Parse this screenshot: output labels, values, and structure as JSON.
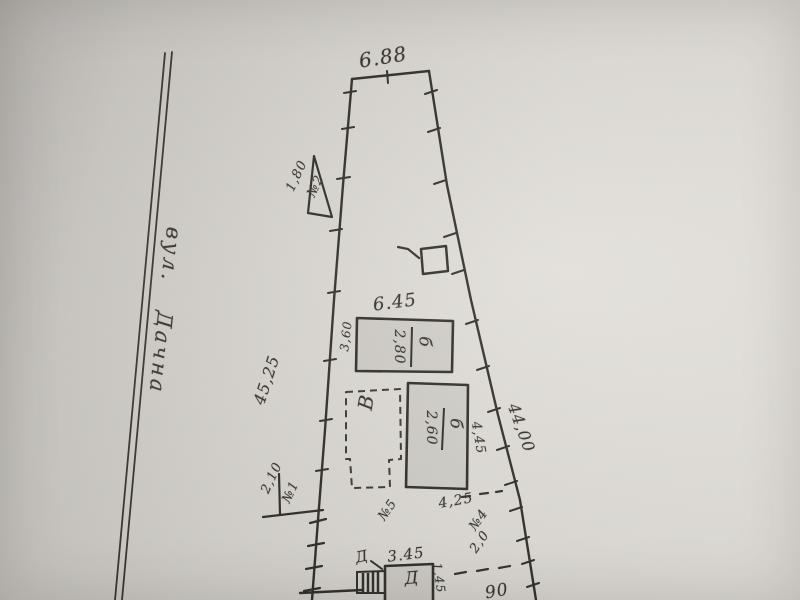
{
  "street": {
    "prefix": "вул.",
    "name": "Дачна"
  },
  "plot": {
    "top_width": "6.88",
    "left_length": "45,25",
    "right_length": "44,00"
  },
  "markers": {
    "n1": {
      "label": "№1",
      "value": "2,10"
    },
    "n2": {
      "label": "№2",
      "value": "1,80"
    },
    "n4": {
      "label": "№4",
      "value": "2,0"
    },
    "n5": {
      "label": "№5"
    }
  },
  "buildings": {
    "b1": {
      "letter": "б",
      "height": "2,80",
      "width": "6.45",
      "depth": "3,60"
    },
    "b2": {
      "letter": "б",
      "height": "2,60",
      "side": "4,45",
      "width": "4,25"
    },
    "v": {
      "letter": "В"
    },
    "d": {
      "letter": "Д",
      "callout": "Д",
      "width": "3.45",
      "side": "1,45"
    }
  },
  "fragments": {
    "bottom_right": "90"
  }
}
